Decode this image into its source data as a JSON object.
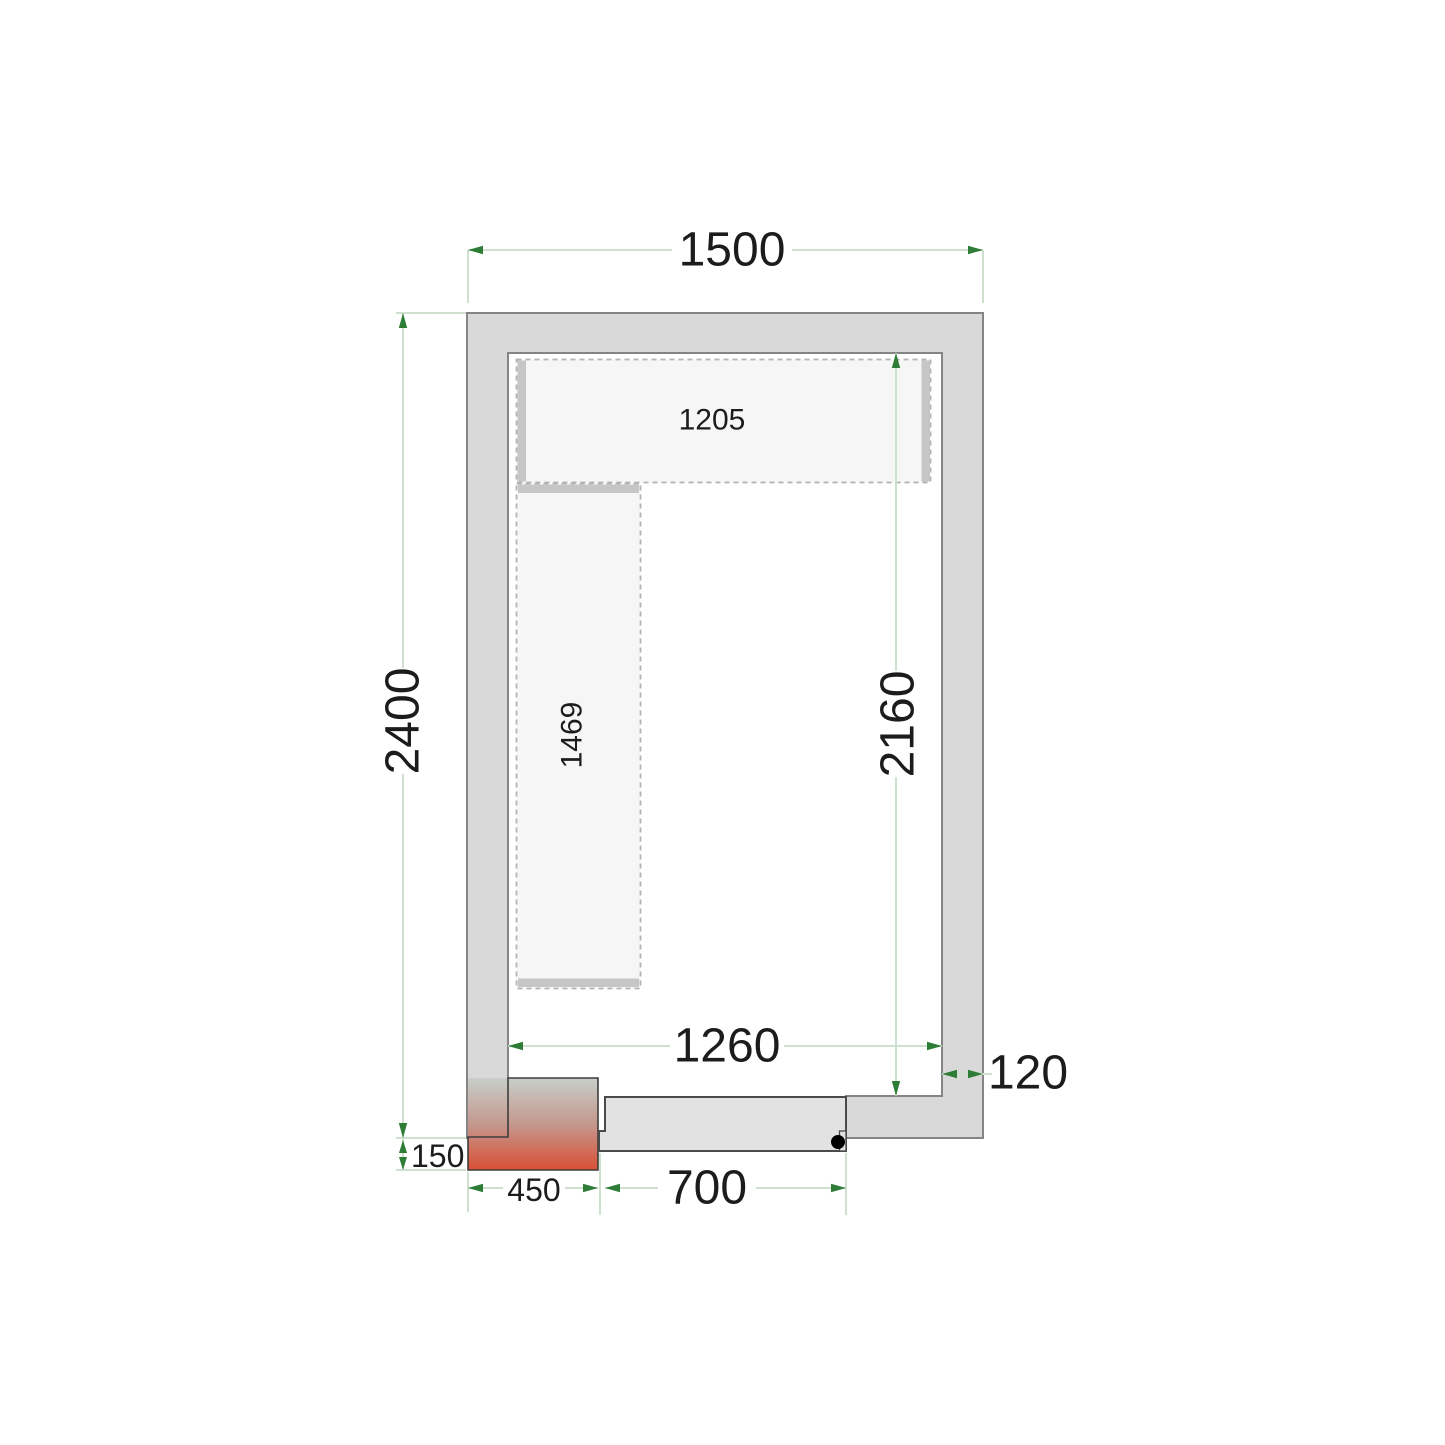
{
  "dims": {
    "outer_width": "1500",
    "outer_height": "2400",
    "inner_height": "2160",
    "inner_width": "1260",
    "wall_thickness": "120",
    "sill_depth": "150",
    "corner_block_width": "450",
    "door_width": "700"
  },
  "shelves": {
    "top_length": "1205",
    "left_length": "1469"
  },
  "colors": {
    "wall_fill": "#d9d9d9",
    "wall_stroke": "#858585",
    "dim_line": "#cfe0cf",
    "arrow": "#2e7d36",
    "text": "#1c1c1c",
    "shelf_fill": "#f6f6f6",
    "shelf_dash": "#b3b3b3",
    "shelf_bar": "#c6c6c6",
    "door_fill": "#e2e2e2",
    "door_stroke": "#4a4a4a",
    "heater_top": "#c8cec9",
    "heater_mid": "#c4988e",
    "heater_bottom": "#d94f35",
    "hinge_dot": "#000000"
  }
}
